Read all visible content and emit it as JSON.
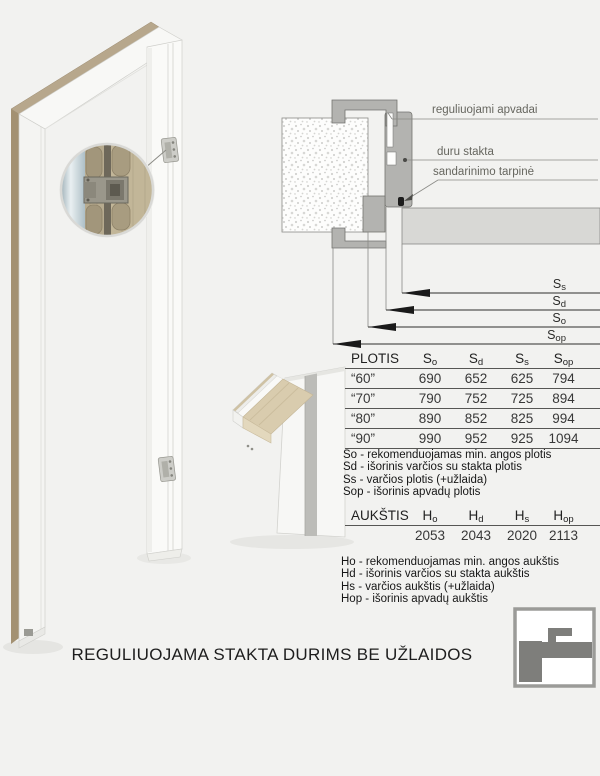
{
  "page": {
    "background": "#f2f2f0",
    "title": "REGULIUOJAMA STAKTA DURIMS BE UŽLAIDOS"
  },
  "colors": {
    "section_gray": "#b3b3b0",
    "door_leaf_gray": "#d8d8d5",
    "wood_edge": "#b7a78c",
    "label_gray": "#66665f",
    "logo_gray": "#7e7e7b"
  },
  "cross_section": {
    "labels": [
      "reguliuojami apvadai",
      "duru stakta",
      "sandarinimo tarpinė"
    ],
    "dims": [
      {
        "base": "S",
        "sub": "s"
      },
      {
        "base": "S",
        "sub": "d"
      },
      {
        "base": "S",
        "sub": "o"
      },
      {
        "base": "S",
        "sub": "op"
      }
    ]
  },
  "width_table": {
    "title": "PLOTIS",
    "columns": [
      {
        "base": "S",
        "sub": "o"
      },
      {
        "base": "S",
        "sub": "d"
      },
      {
        "base": "S",
        "sub": "s"
      },
      {
        "base": "S",
        "sub": "op"
      }
    ],
    "rows": [
      {
        "size": "“60”",
        "so": "690",
        "sd": "652",
        "ss": "625",
        "sop": "794"
      },
      {
        "size": "“70”",
        "so": "790",
        "sd": "752",
        "ss": "725",
        "sop": "894"
      },
      {
        "size": "“80”",
        "so": "890",
        "sd": "852",
        "ss": "825",
        "sop": "994"
      },
      {
        "size": "“90”",
        "so": "990",
        "sd": "952",
        "ss": "925",
        "sop": "1094"
      }
    ],
    "legend": [
      "So - rekomenduojamas min. angos plotis",
      "Sd - išorinis varčios su stakta plotis",
      "Ss - varčios plotis (+užlaida)",
      "Sop - išorinis apvadų plotis"
    ]
  },
  "height_table": {
    "title": "AUKŠTIS",
    "columns": [
      {
        "base": "H",
        "sub": "o"
      },
      {
        "base": "H",
        "sub": "d"
      },
      {
        "base": "H",
        "sub": "s"
      },
      {
        "base": "H",
        "sub": "op"
      }
    ],
    "values": [
      "2053",
      "2043",
      "2020",
      "2113"
    ],
    "legend": [
      "Ho - rekomenduojamas min. angos aukštis",
      "Hd - išorinis varčios su stakta aukštis",
      "Hs - varčios aukštis (+užlaida)",
      "Hop - išorinis apvadų aukštis"
    ]
  }
}
